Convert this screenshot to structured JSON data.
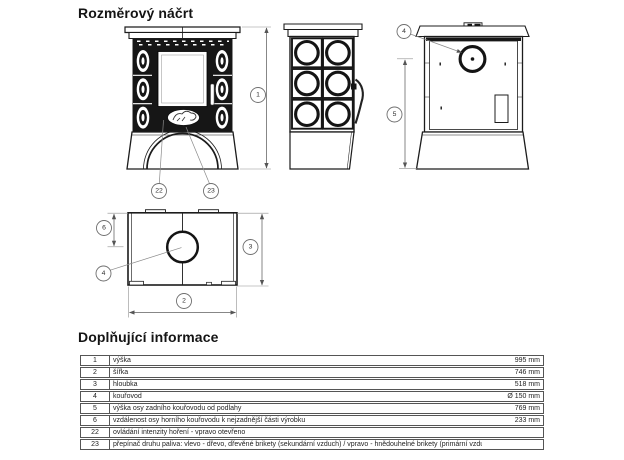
{
  "page": {
    "title_drawing": "Rozměrový náčrt",
    "title_info": "Doplňující informace"
  },
  "drawing": {
    "callouts": {
      "c1": "1",
      "c2": "2",
      "c3": "3",
      "c4": "4",
      "c5": "5",
      "c6": "6",
      "c22": "22",
      "c23": "23"
    }
  },
  "info_table": {
    "rows": [
      {
        "num": "1",
        "label": "výška",
        "value": "995 mm"
      },
      {
        "num": "2",
        "label": "šířka",
        "value": "746 mm"
      },
      {
        "num": "3",
        "label": "hloubka",
        "value": "518 mm"
      },
      {
        "num": "4",
        "label": "kouřovod",
        "value": "Ø 150 mm"
      },
      {
        "num": "5",
        "label": "výška osy zadního kouřovodu od podlahy",
        "value": "769 mm"
      },
      {
        "num": "6",
        "label": "vzdálenost osy horního kouřovodu k nejzadnější části výrobku",
        "value": "233 mm"
      },
      {
        "num": "22",
        "label": "ovládání intenzity hoření - vpravo otevřeno",
        "value": ""
      },
      {
        "num": "23",
        "label": "přepínač druhu paliva: vlevo - dřevo, dřevěné brikety (sekundární vzduch) / vpravo - hnědouhelné brikety (primární vzduch)",
        "value": ""
      }
    ]
  }
}
